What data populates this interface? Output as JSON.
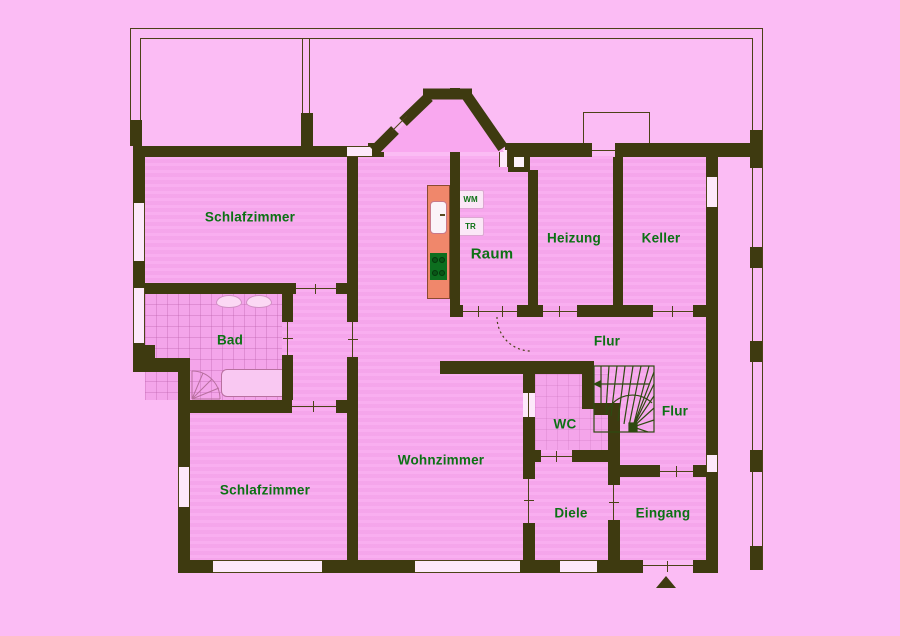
{
  "plan": {
    "rooms": {
      "schlafzimmer_top": "Schlafzimmer",
      "bad": "Bad",
      "schlafzimmer_bottom": "Schlafzimmer",
      "wohnzimmer": "Wohnzimmer",
      "raum": "Raum",
      "heizung": "Heizung",
      "keller": "Keller",
      "flur_upper": "Flur",
      "flur_lower": "Flur",
      "wc": "WC",
      "diele": "Diele",
      "eingang": "Eingang"
    },
    "appliances": {
      "washing_machine": "WM",
      "dryer": "TR"
    }
  },
  "colors": {
    "outside": "#fbbcf4",
    "room": "#f9a8ef",
    "wall": "#3e3a10",
    "line": "#4c4217",
    "label": "#0c7114",
    "tile": "#f4a5ea",
    "counter": "#f0876b",
    "stove": "#0d6e1f",
    "stairline": "#2e4a10"
  }
}
